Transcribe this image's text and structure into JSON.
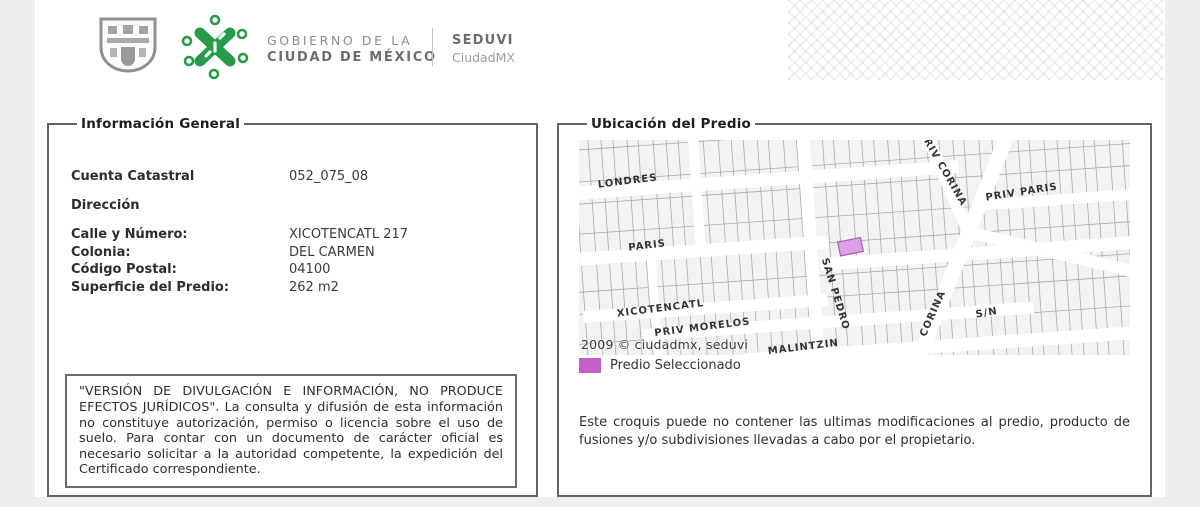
{
  "header": {
    "gobierno_line1": "GOBIERNO DE LA",
    "gobierno_line2": "CIUDAD DE MÉXICO",
    "agency": "SEDUVI",
    "platform": "CiudadMX"
  },
  "info_panel": {
    "title": "Información General",
    "fields": [
      {
        "label": "Cuenta Catastral",
        "value": "052_075_08"
      },
      {
        "label": "Dirección",
        "value": ""
      },
      {
        "label": "Calle y Número:",
        "value": "XICOTENCATL 217"
      },
      {
        "label": "Colonia:",
        "value": "DEL CARMEN"
      },
      {
        "label": "Código Postal:",
        "value": "04100"
      },
      {
        "label": "Superficie del Predio:",
        "value": "262 m2"
      }
    ],
    "disclaimer": "\"VERSIÓN DE DIVULGACIÓN E INFORMACIÓN, NO PRODUCE EFECTOS JURÍDICOS\". La consulta y difusión de esta información no constituye autorización, permiso o licencia sobre el uso de suelo. Para contar con un documento de carácter oficial es necesario solicitar a la autoridad competente, la expedición del Certificado correspondiente."
  },
  "map_panel": {
    "title": "Ubicación del Predio",
    "copyright": "2009 © ciudadmx, seduvi",
    "legend_label": "Predio Seleccionado",
    "note": "Este croquis puede no contener las ultimas modificaciones al predio, producto de fusiones y/o subdivisiones llevadas a cabo por el propietario.",
    "streets": [
      {
        "name": "LONDRES",
        "x": 24,
        "y": 30,
        "rot": -3
      },
      {
        "name": "PARIS",
        "x": 50,
        "y": 95,
        "rot": -3
      },
      {
        "name": "XICOTENCATL",
        "x": 34,
        "y": 160,
        "rot": -3
      },
      {
        "name": "PRIV MORELOS",
        "x": 70,
        "y": 182,
        "rot": -3
      },
      {
        "name": "MALINTZIN",
        "x": 182,
        "y": 208,
        "rot": -3
      },
      {
        "name": "SAN PEDRO",
        "x": 242,
        "y": 117,
        "rot": 77
      },
      {
        "name": "RIV CORINA",
        "x": 352,
        "y": 6,
        "rot": 64
      },
      {
        "name": "PRIV PARIS",
        "x": 410,
        "y": 70,
        "rot": -5
      },
      {
        "name": "CORINA",
        "x": 340,
        "y": 202,
        "rot": -62
      },
      {
        "name": "S/N",
        "x": 392,
        "y": 186,
        "rot": -6
      }
    ],
    "colors": {
      "selected_parcel_fill": "#df9fe6",
      "selected_parcel_stroke": "#a75fb5",
      "legend_swatch": "#c45fc9",
      "accent_green": "#279b4a"
    }
  }
}
